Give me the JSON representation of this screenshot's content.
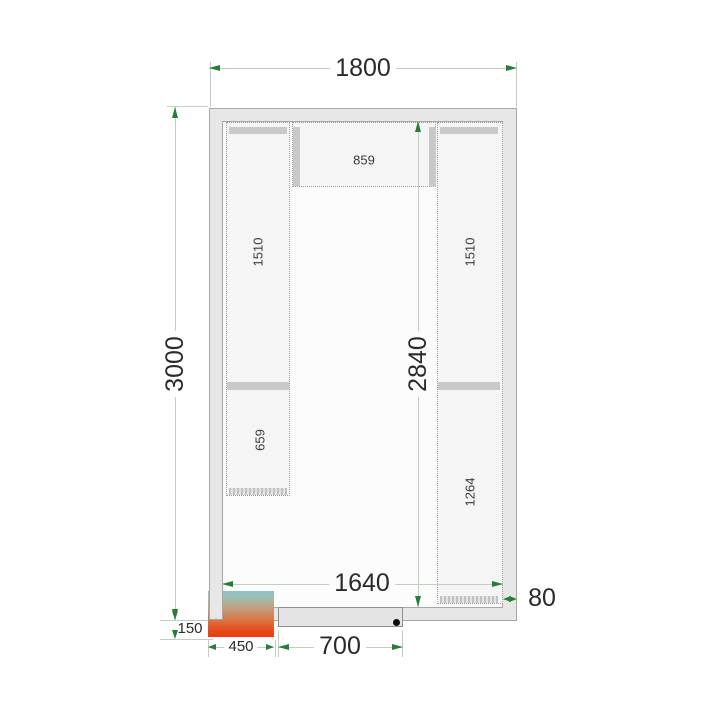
{
  "drawing": {
    "type": "cold-room-floor-plan"
  },
  "dims": {
    "outer_width": {
      "label": "1800"
    },
    "outer_height": {
      "label": "3000"
    },
    "inner_height": {
      "label": "2840"
    },
    "inner_width": {
      "label": "1640"
    },
    "wall_thickness": {
      "label": "80"
    },
    "unit_protrusion": {
      "label": "150"
    },
    "unit_width": {
      "label": "450"
    },
    "door_width": {
      "label": "700"
    }
  },
  "shelves": {
    "top_label": "859",
    "left_upper_label": "1510",
    "left_lower_label": "659",
    "right_upper_label": "1510",
    "right_lower_label": "1264"
  },
  "colors": {
    "wall_fill": "#e7e7e7",
    "wall_border": "#a6a6a6",
    "floor": "#fcfcfc",
    "shelf_fill": "#f5f5f5",
    "dimension_line": "#bcd2be",
    "arrow_green": "#267d36",
    "unit_gradient_top": "#8cc6c8",
    "unit_gradient_bottom": "#ea3a0c",
    "handle_dot": "#0a0a0a"
  }
}
